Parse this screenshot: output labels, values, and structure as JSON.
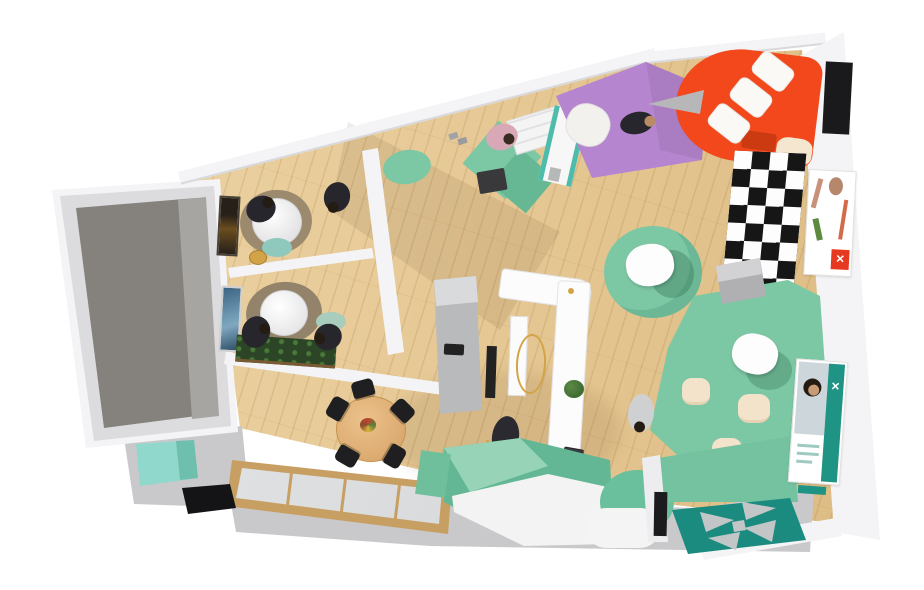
{
  "palette": {
    "background": "#ffffff",
    "wall_white": "#f4f4f6",
    "wall_shadow": "#d9d9dc",
    "wood_floor": "#e5c793",
    "walkway_grey": "#c9c9cb",
    "backroom_wall": "#dcdcde",
    "backroom_floor_dark": "#85827d",
    "backroom_floor_light": "#a7a5a1",
    "teal_rug": "#7cc7a4",
    "teal_mid": "#63b794",
    "teal_mint": "#97d4b7",
    "teal_deep": "#1b8b7f",
    "teal_wall": "#74c29f",
    "mint_cabinet": "#8fd8cb",
    "purple_rug": "#b585cf",
    "orange_sofa": "#f2481b",
    "cream_pouf": "#f3e3cb",
    "rug_brown": "#9b8a6e",
    "gold": "#d2a347",
    "chair_black": "#1f1f22",
    "table_wood": "#e3b77f",
    "case_wood": "#c89f63",
    "glass_grey": "#d8dadc",
    "plant_green": "#3f6b33",
    "poster_red": "#e6391f",
    "poster_teal": "#1f9384",
    "skin": "#c79b76",
    "dark_clothes": "#26262c"
  },
  "icons": {
    "brand_x_logo": "✕",
    "pinwheel_logo": "✕"
  },
  "scene": {
    "view": "isometric-3d-floorplan",
    "people_total": 8,
    "areas": [
      {
        "name": "back-room",
        "items": [
          "grey-concrete-floor"
        ]
      },
      {
        "name": "meeting-room-1",
        "people": 2,
        "items": [
          "round-white-table",
          "brown-area-rug",
          "wall-art",
          "teal-pouf",
          "gold-stool"
        ]
      },
      {
        "name": "meeting-room-2",
        "people": 2,
        "items": [
          "round-white-table",
          "brown-area-rug",
          "blue-wall-art",
          "planter-box",
          "teal-pouf"
        ]
      },
      {
        "name": "dining-room",
        "items": [
          "round-wood-table",
          "black-chairs",
          "flower-bouquet",
          "glass-display-case",
          "mint-sideboard",
          "black-floor-mat"
        ]
      },
      {
        "name": "open-showroom",
        "people": 3,
        "items": [
          "l-shaped-counter",
          "grey-cabinet",
          "gold-clothing-rack",
          "white-display-panel",
          "laptop",
          "potted-plant",
          "black-stool",
          "gold-floor-lamp",
          "teal-round-rug",
          "white-lounge-chairs",
          "cream-poufs",
          "teal-carpet",
          "grey-bench",
          "white-shelf-display",
          "teal-display-stand",
          "dark-ottoman",
          "teal-diamond-rugs",
          "shoe-display"
        ]
      },
      {
        "name": "lounge-corner",
        "people": 1,
        "items": [
          "orange-curved-sofa",
          "white-cushions",
          "grey-cone-lamp",
          "checkered-rug",
          "purple-rug",
          "white-pouf",
          "cream-pouf"
        ]
      },
      {
        "name": "entry",
        "items": [
          "teal-floor-graphic",
          "mint-floor-band",
          "white-path",
          "teal-semicircle",
          "mosaic-entry-mat",
          "black-door",
          "teal-wall"
        ]
      },
      {
        "name": "right-wall",
        "items": [
          "black-wall-panel",
          "red-brand-poster",
          "teal-brand-poster"
        ]
      }
    ]
  }
}
